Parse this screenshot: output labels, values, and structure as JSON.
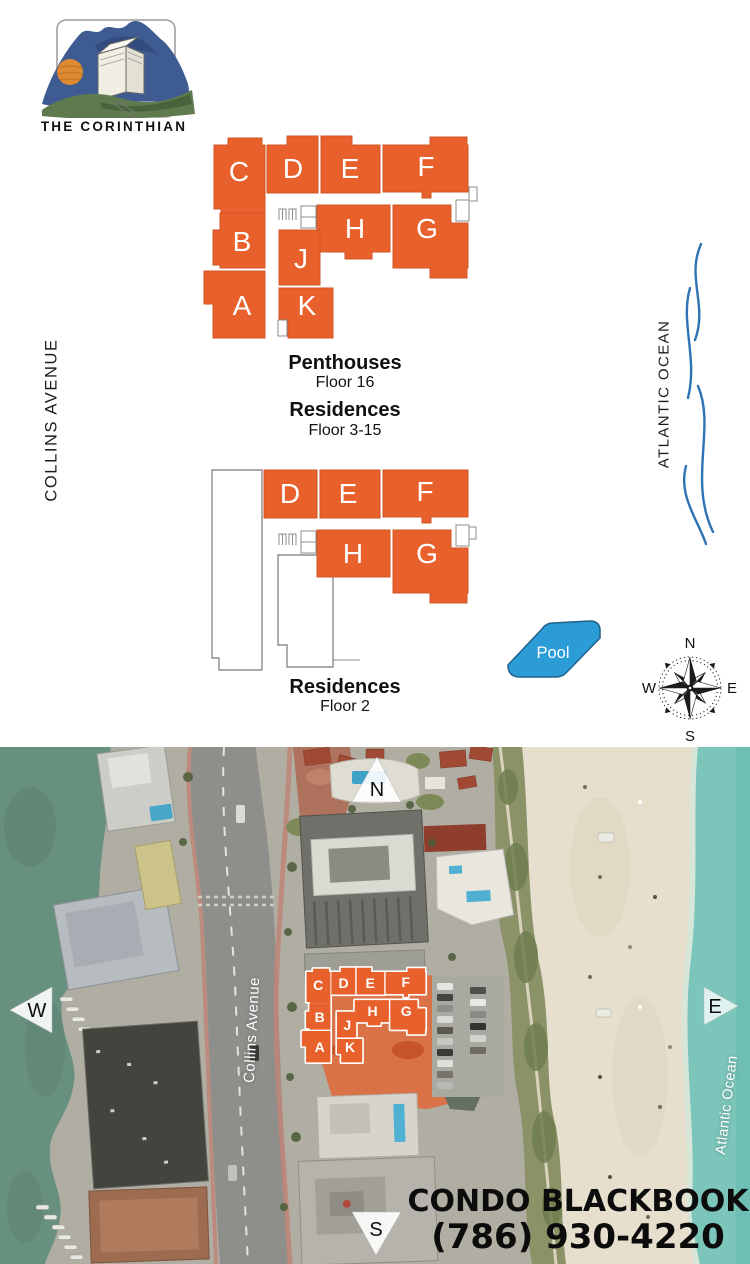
{
  "logo": {
    "title": "THE CORINTHIAN"
  },
  "labels": {
    "street": "COLLINS AVENUE",
    "ocean": "ATLANTIC OCEAN"
  },
  "plan_upper": {
    "units": [
      "C",
      "D",
      "E",
      "F",
      "B",
      "H",
      "G",
      "J",
      "A",
      "K"
    ],
    "caption1_title": "Penthouses",
    "caption1_sub": "Floor 16",
    "caption2_title": "Residences",
    "caption2_sub": "Floor 3-15"
  },
  "plan_lower": {
    "units": [
      "D",
      "E",
      "F",
      "H",
      "G"
    ],
    "caption_title": "Residences",
    "caption_sub": "Floor 2"
  },
  "pool": {
    "label": "Pool"
  },
  "compass": {
    "n": "N",
    "e": "E",
    "s": "S",
    "w": "W"
  },
  "aerial": {
    "street": "Collins Avenue",
    "ocean": "Atlantic Ocean",
    "marker_n": "N",
    "marker_w": "W",
    "marker_e": "E",
    "marker_s": "S",
    "units": [
      "C",
      "D",
      "E",
      "F",
      "B",
      "H",
      "G",
      "J",
      "A",
      "K"
    ],
    "brand": "CONDO BLACKBOOK",
    "phone": "(786) 930-4220"
  },
  "colors": {
    "unit_orange": "#E8612C",
    "pool_blue": "#2B9CD6",
    "wave_blue": "#2E74B5",
    "bay_water": "#68907F",
    "ocean_teal": "#7CC5BA",
    "sand": "#E6DFCD"
  }
}
